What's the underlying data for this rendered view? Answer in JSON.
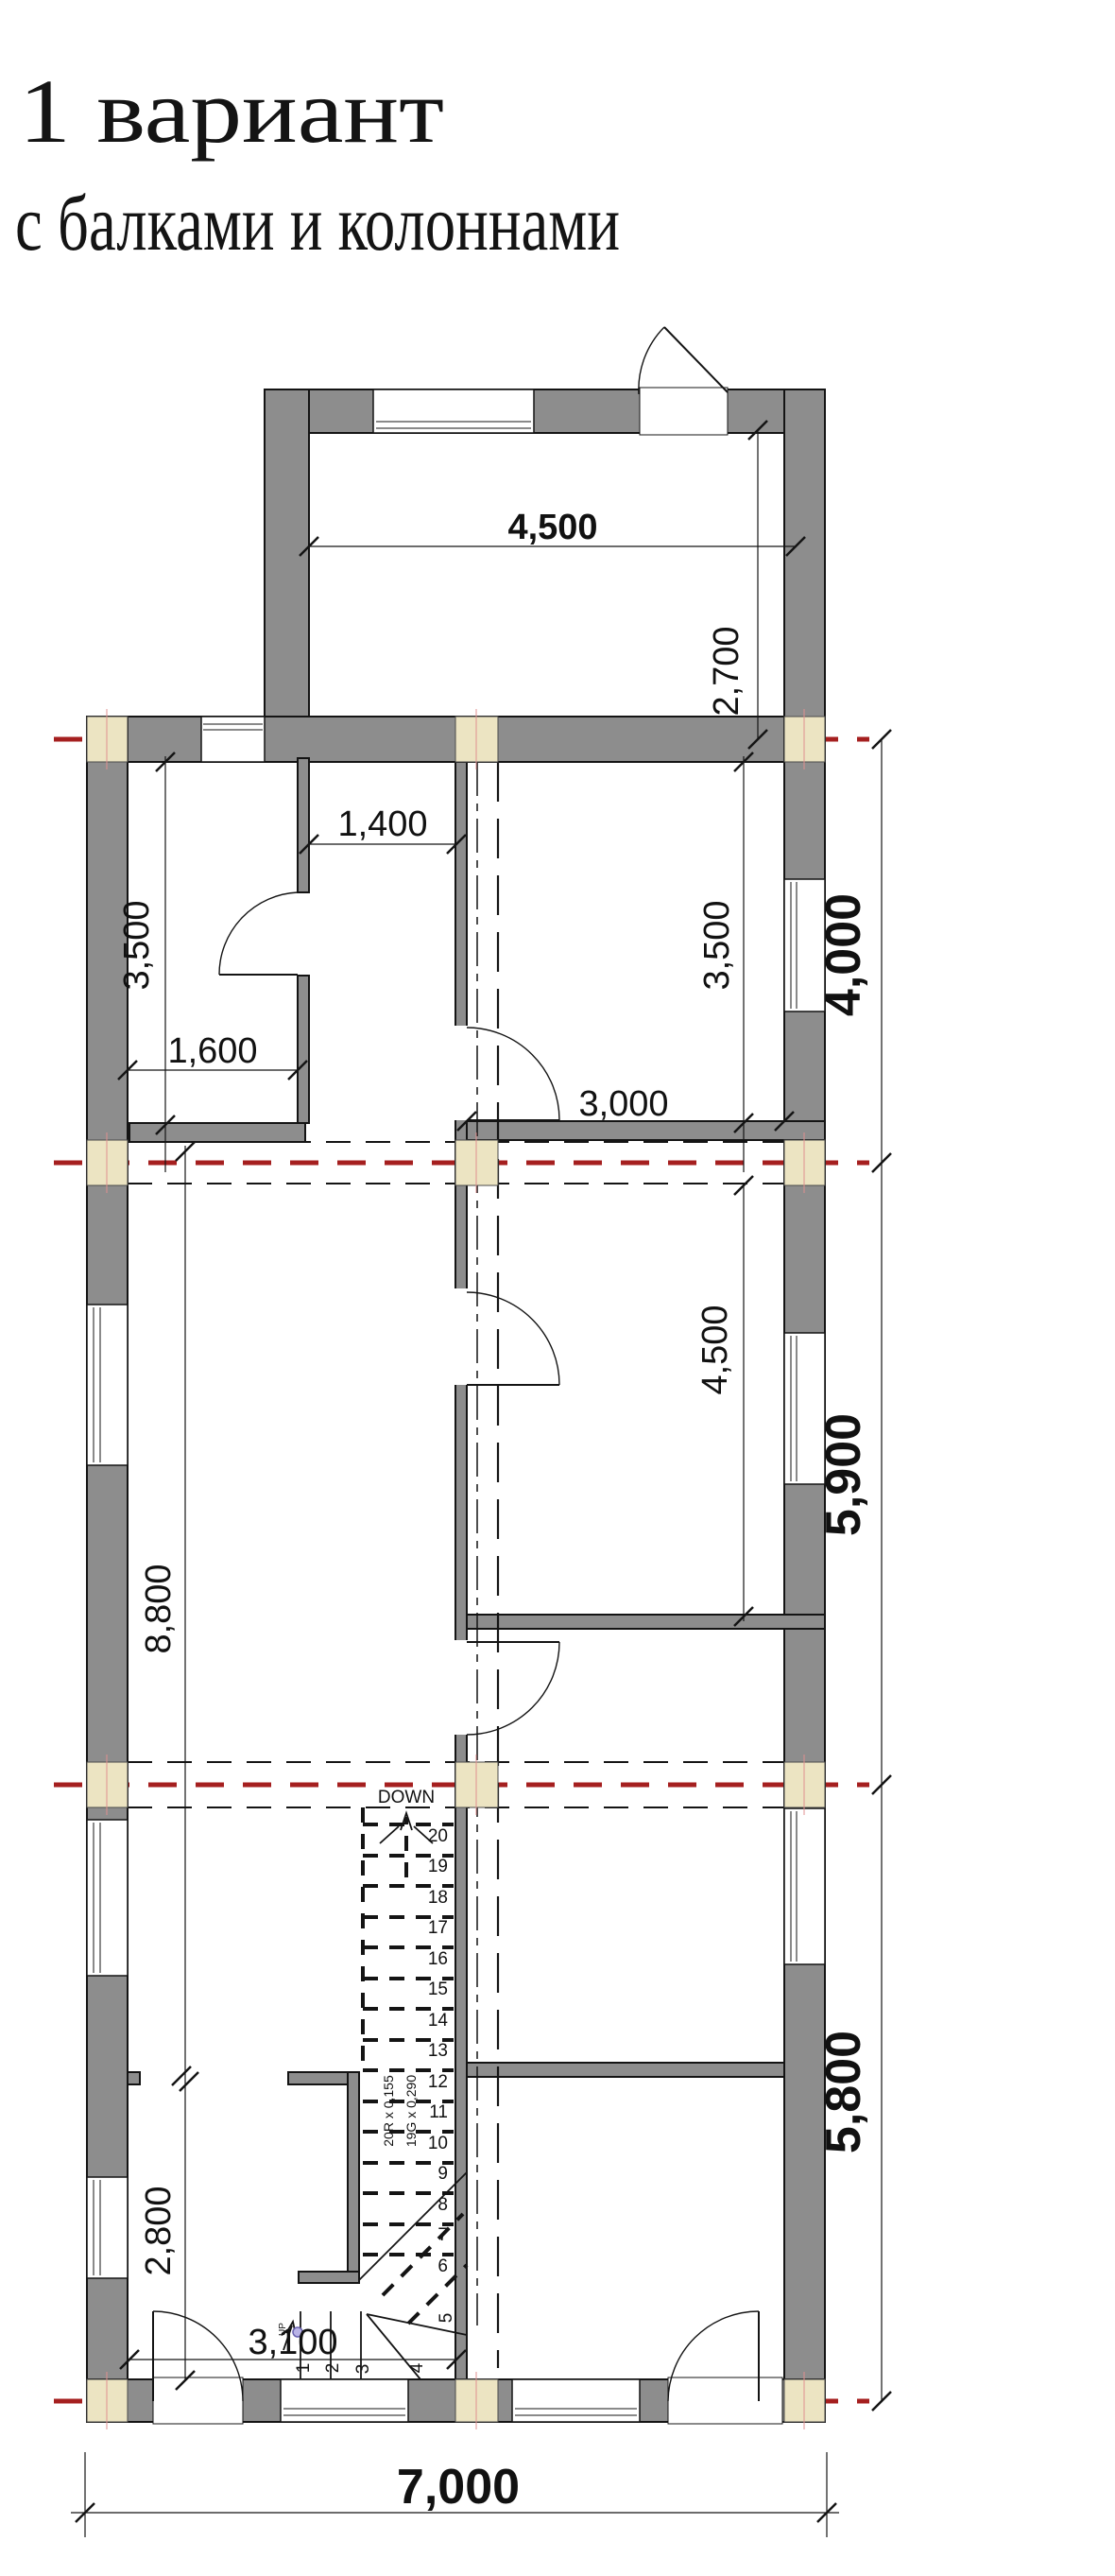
{
  "title": {
    "line1": "1 вариант",
    "line2": "с балками и колоннами"
  },
  "dimensions": {
    "entrance_width": "4,500",
    "entrance_depth": "2,700",
    "hall_opening": "1,400",
    "left_room_depth": "3,500",
    "right_room_depth": "3,500",
    "bay_1": "4,000",
    "left_room_width": "1,600",
    "right_room_width": "3,000",
    "hall_depth": "8,800",
    "middle_room_depth": "4,500",
    "bay_2": "5,900",
    "bay_3": "5,800",
    "entry_zone_depth": "2,800",
    "stair_zone_width": "3,100",
    "total_width": "7,000"
  },
  "stairs": {
    "label_down": "DOWN",
    "label_up": "UP",
    "note_risers": "20R x 0,155",
    "note_goings": "19G x 0,290",
    "numbers": [
      "1",
      "2",
      "3",
      "4",
      "5",
      "6",
      "7",
      "8",
      "9",
      "10",
      "11",
      "12",
      "13",
      "14",
      "15",
      "16",
      "17",
      "18",
      "19",
      "20"
    ]
  },
  "colors": {
    "wall_gray": "#8d8d8d",
    "column_tan": "#ece4c2",
    "grid_red": "#a51f1f",
    "outline_black": "#141414",
    "cursor_lavender": "#b9b3e6"
  }
}
